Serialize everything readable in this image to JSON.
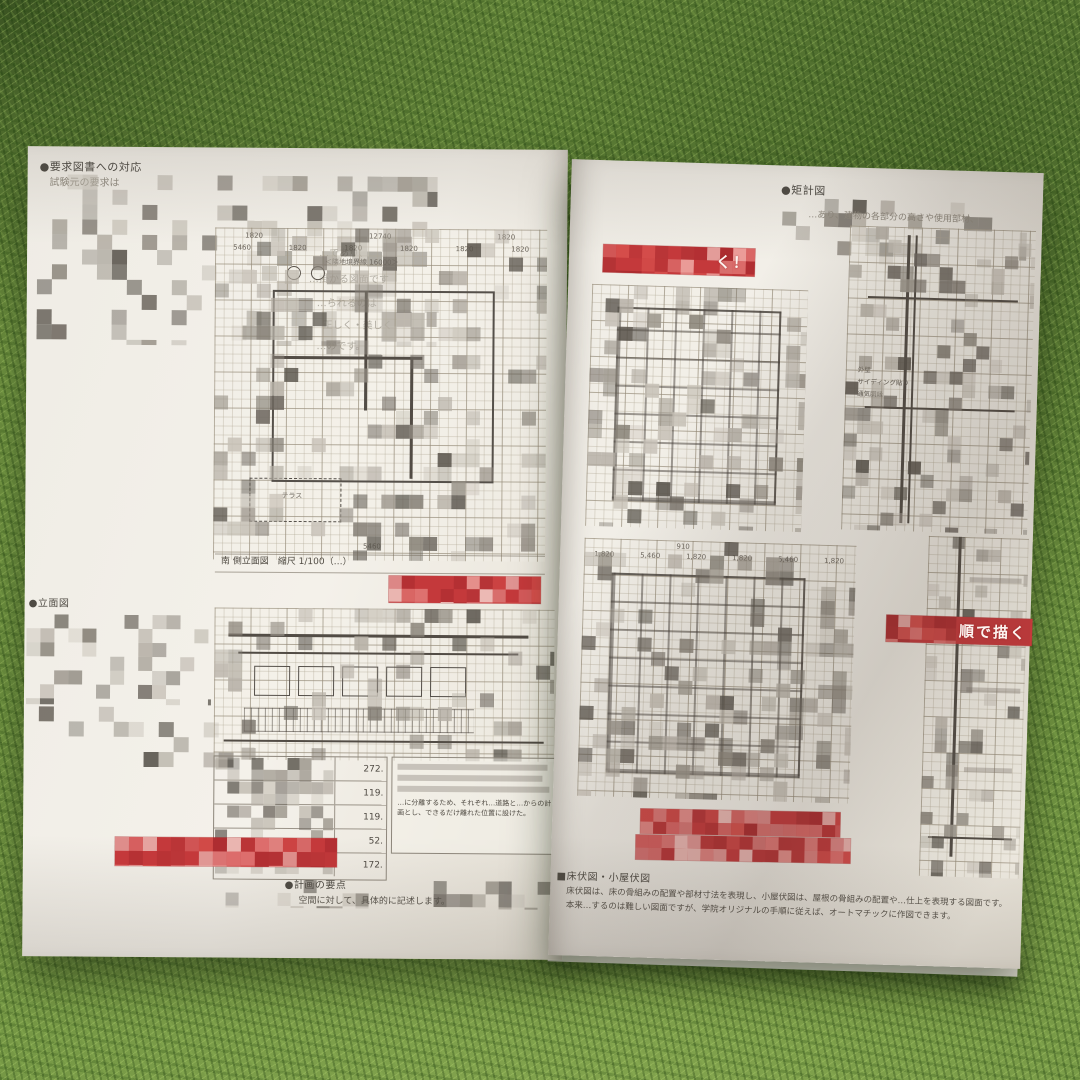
{
  "colors": {
    "accent_red": "#c4393b",
    "page": "#f2efe8",
    "carpet_green": "#6e9140"
  },
  "left_page": {
    "intro": {
      "heading": "●要求図書への対応",
      "subline": "試験元の要求は",
      "fragments": [
        "…であり、",
        "…掛かる図面です",
        "…られるのは",
        "正しく・美しく",
        "…のです。"
      ]
    },
    "floor_plan": {
      "boundary_label": "＜隣地境界線 16000＞",
      "dims_row1": [
        "1820",
        "12740",
        "1820"
      ],
      "dims_row2": [
        "5460",
        "1820",
        "1820",
        "1820",
        "1820",
        "1820"
      ],
      "terrace_label": "テラス",
      "bottom_dim": "5460",
      "caption": "南 側立面図　縮尺 1/100（…）"
    },
    "side_note": {
      "heading": "●立面図"
    },
    "area_table": {
      "values": [
        "272.",
        "119.",
        "119.",
        "52.",
        "172."
      ],
      "note_fragment": "…に分離するため、それぞれ…道路と…からの計画とし、できるだけ離れた位置に設けた。"
    },
    "footer": {
      "heading": "●計画の要点",
      "line": "空間に対して、具体的に記述します。"
    }
  },
  "right_page": {
    "intro": {
      "heading": "●矩計図",
      "fragment": "…あり、建物の各部分の高さや使用部材、"
    },
    "banner_top": {
      "visible_text": "く！"
    },
    "detail_labels": [
      "外壁",
      "サイディング貼り",
      "通気胴縁"
    ],
    "lower_plan": {
      "dims": [
        "1,820",
        "5,460",
        "1,820",
        "1,820",
        "5,460",
        "1,820"
      ],
      "dim_small": "910"
    },
    "banner_right": {
      "visible_text": "順で描く"
    },
    "footer": {
      "heading": "■床伏図・小屋伏図",
      "line1": "床伏図は、床の骨組みの配置や部材寸法を表現し、小屋伏図は、屋根の骨組みの配置や…仕上を表現する図面です。",
      "line2": "本来…するのは難しい図面ですが、学院オリジナルの手順に従えば、オートマチックに作図できます。"
    }
  }
}
